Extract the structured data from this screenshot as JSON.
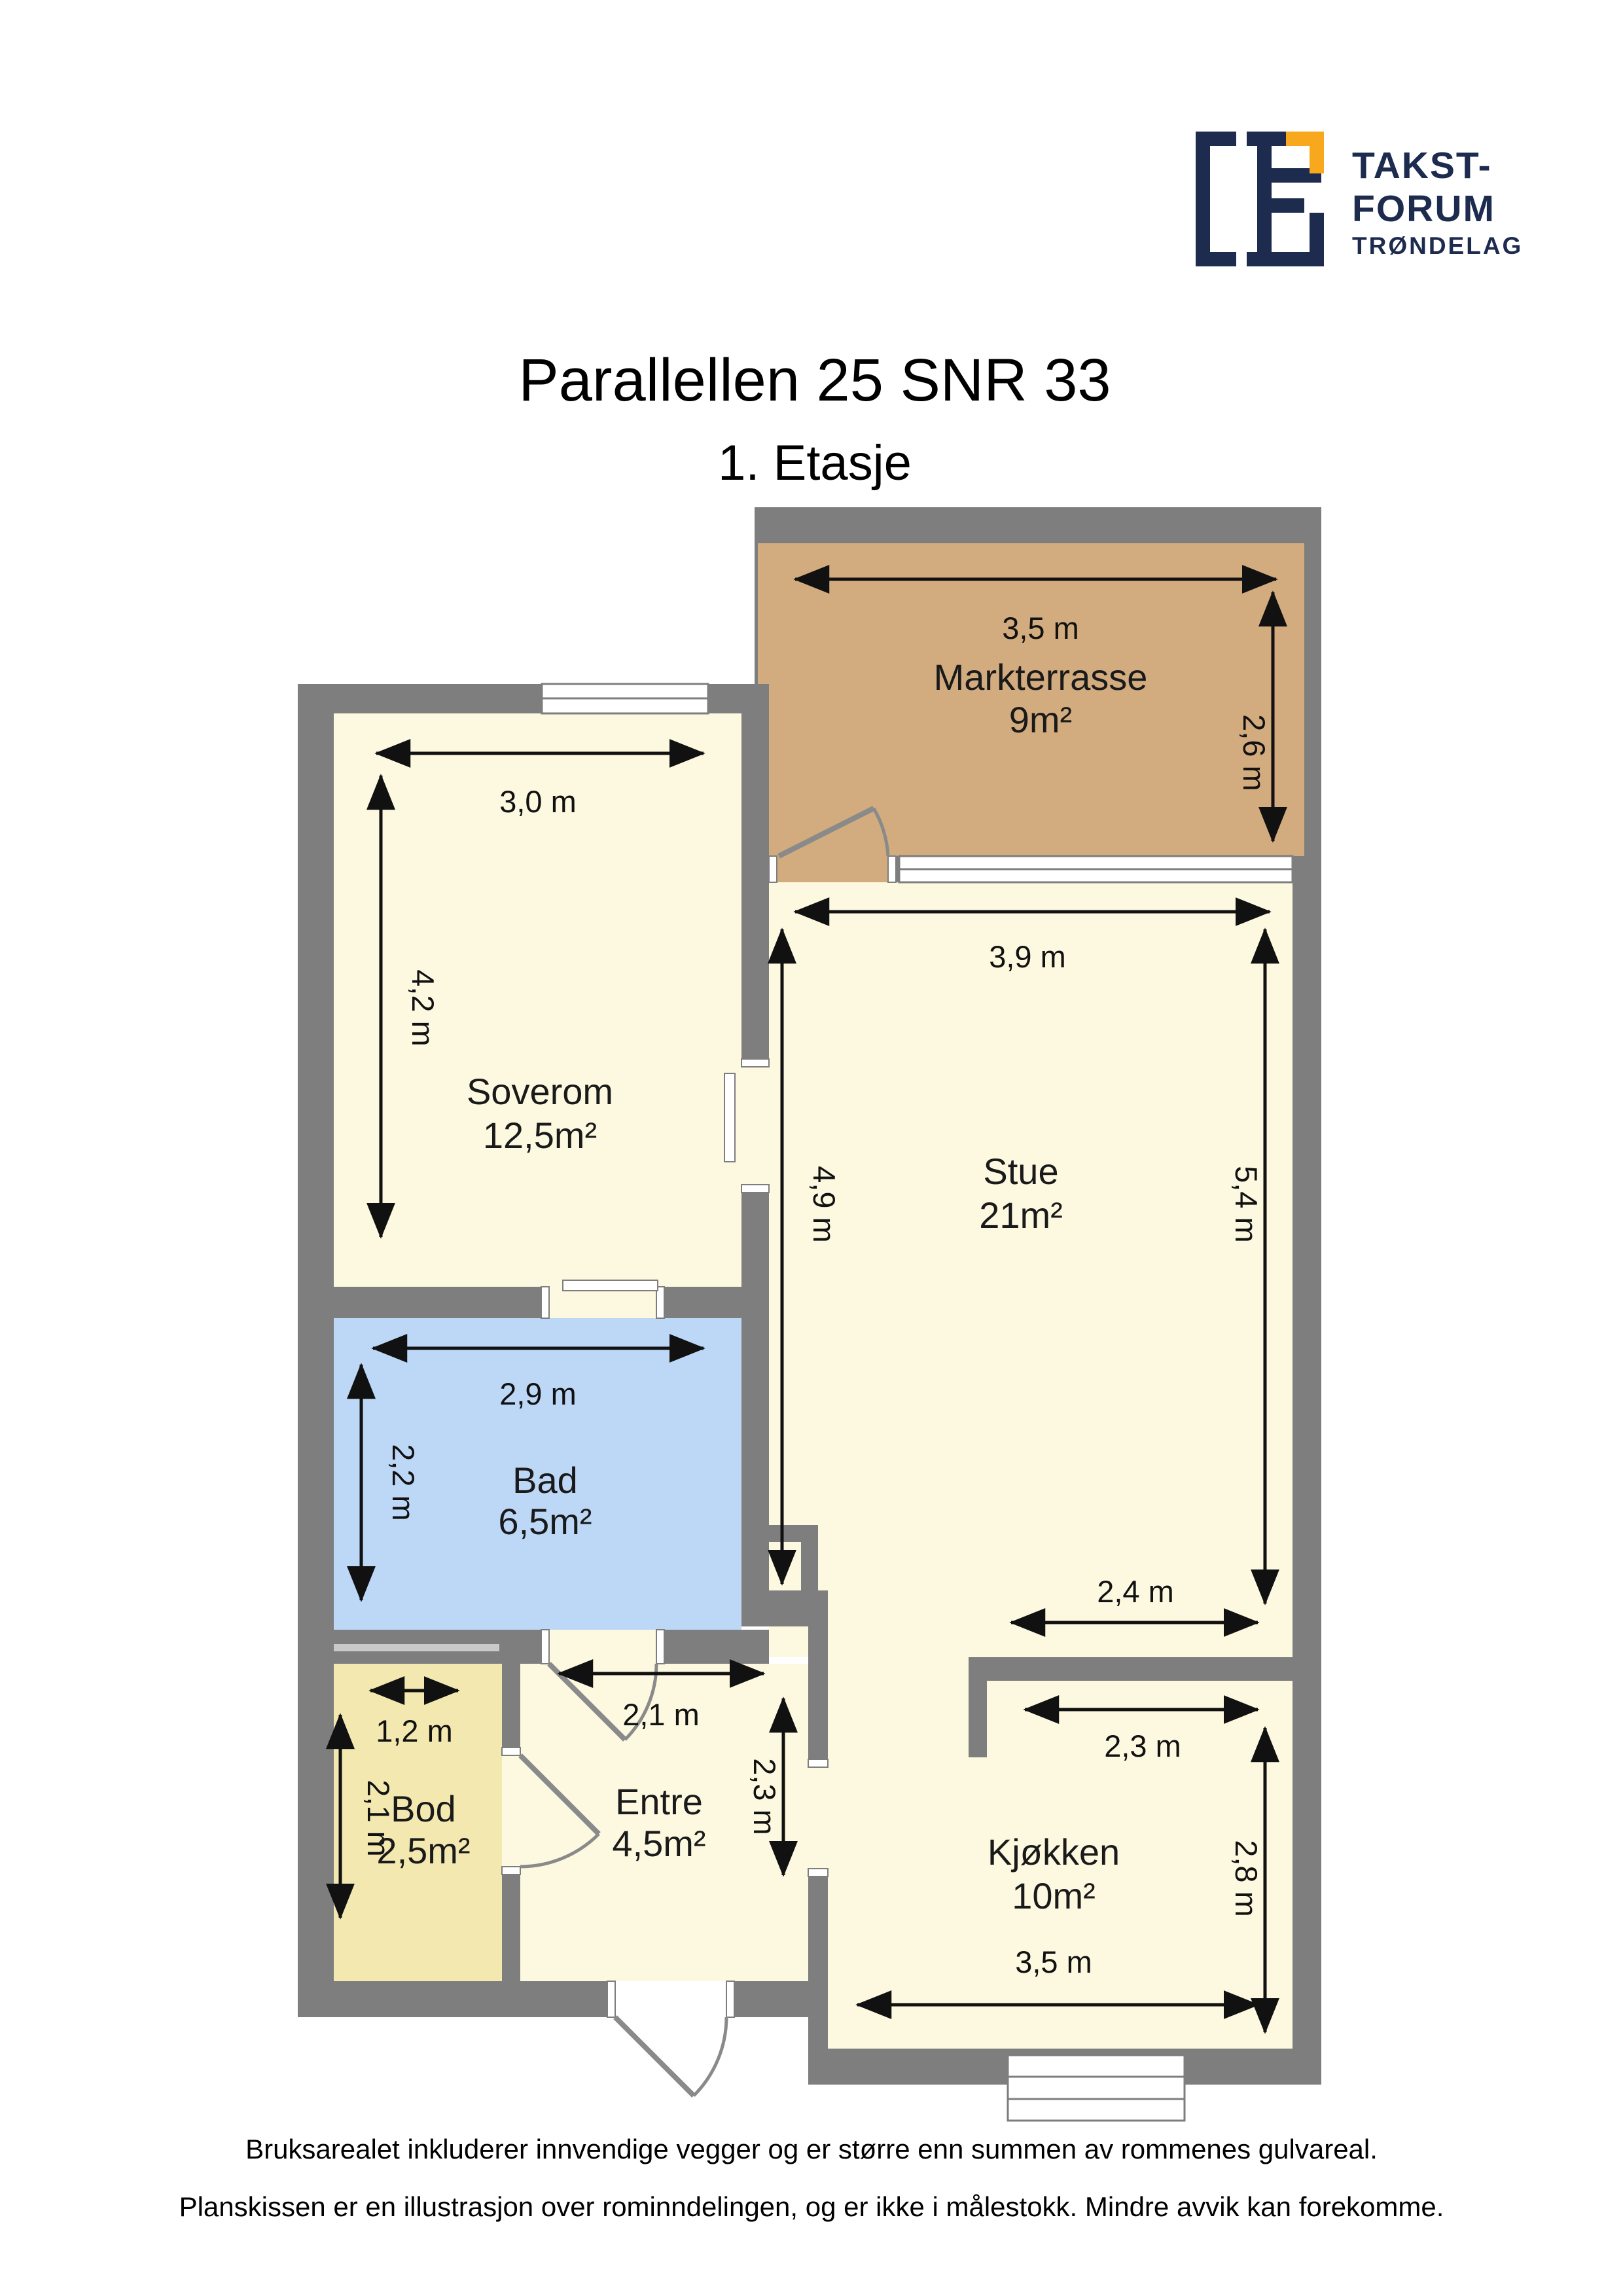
{
  "header": {
    "title": "Parallellen 25 SNR 33",
    "subtitle": "1. Etasje"
  },
  "logo": {
    "line1": "TAKST-",
    "line2": "FORUM",
    "line3": "TRØNDELAG"
  },
  "rooms": [
    {
      "name": "Markterrasse",
      "area": "9m²"
    },
    {
      "name": "Soverom",
      "area": "12,5m²"
    },
    {
      "name": "Stue",
      "area": "21m²"
    },
    {
      "name": "Bad",
      "area": "6,5m²"
    },
    {
      "name": "Bod",
      "area": "2,5m²"
    },
    {
      "name": "Entre",
      "area": "4,5m²"
    },
    {
      "name": "Kjøkken",
      "area": "10m²"
    }
  ],
  "dimensions": {
    "markterrasse_width": "3,5 m",
    "markterrasse_depth": "2,6 m",
    "soverom_width": "3,0 m",
    "soverom_depth": "4,2 m",
    "stue_width": "3,9 m",
    "stue_depth_left": "4,9 m",
    "stue_depth_right": "5,4 m",
    "stue_bottom_width": "2,4 m",
    "bad_width": "2,9 m",
    "bad_depth": "2,2 m",
    "bod_width": "1,2 m",
    "bod_depth": "2,1 m",
    "entre_width": "2,1 m",
    "entre_depth": "2,3 m",
    "kjokken_top_width": "2,3 m",
    "kjokken_depth": "2,8 m",
    "kjokken_bottom_width": "3,5 m"
  },
  "footer": {
    "line1": "Bruksarealet inkluderer innvendige vegger og er større enn summen av rommenes gulvareal.",
    "line2": "Planskissen er en illustrasjon over rominndelingen, og er ikke i målestokk. Mindre avvik kan forekomme."
  },
  "colors": {
    "wall": "#7e7e7e",
    "floor": "#fdf9e0",
    "terrace": "#d2ab7e",
    "bathroom": "#bcd8f6",
    "storage": "#f3e8b0",
    "shelf": "#c9c9c9",
    "logo_navy": "#1d2b4f",
    "logo_orange": "#f8a81c"
  }
}
